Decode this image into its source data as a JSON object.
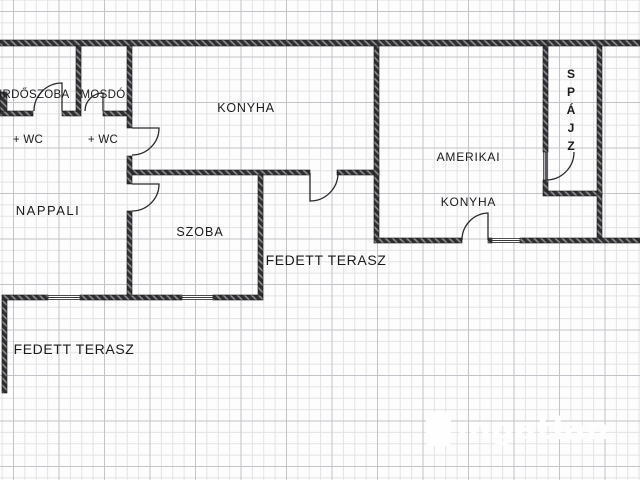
{
  "rooms": {
    "furdoszoba": {
      "line1": "FÜRDŐSZOBA",
      "line2": "+ WC"
    },
    "mosdo": {
      "line1": "MOSDÓ",
      "line2": "+ WC"
    },
    "konyha": {
      "label": "KONYHA"
    },
    "amerikai_konyha": {
      "line1": "AMERIKAI",
      "line2": "KONYHA"
    },
    "spajz": {
      "label": "SPÁJZ"
    },
    "nappali": {
      "label": "NAPPALI"
    },
    "szoba": {
      "label": "SZOBA"
    },
    "terasz_middle": {
      "label": "FEDETT TERASZ"
    },
    "terasz_bottom": {
      "label": "FEDETT TERASZ"
    }
  },
  "watermark": {
    "text": "ingatlan"
  },
  "colors": {
    "wall": "#2f2f31",
    "wall_hatch": "#8a8a8e",
    "grid_major": "#c3c3c9",
    "grid_minor": "#e3e3e7",
    "label_text": "#1b1b1d",
    "watermark": "#ffffff"
  }
}
